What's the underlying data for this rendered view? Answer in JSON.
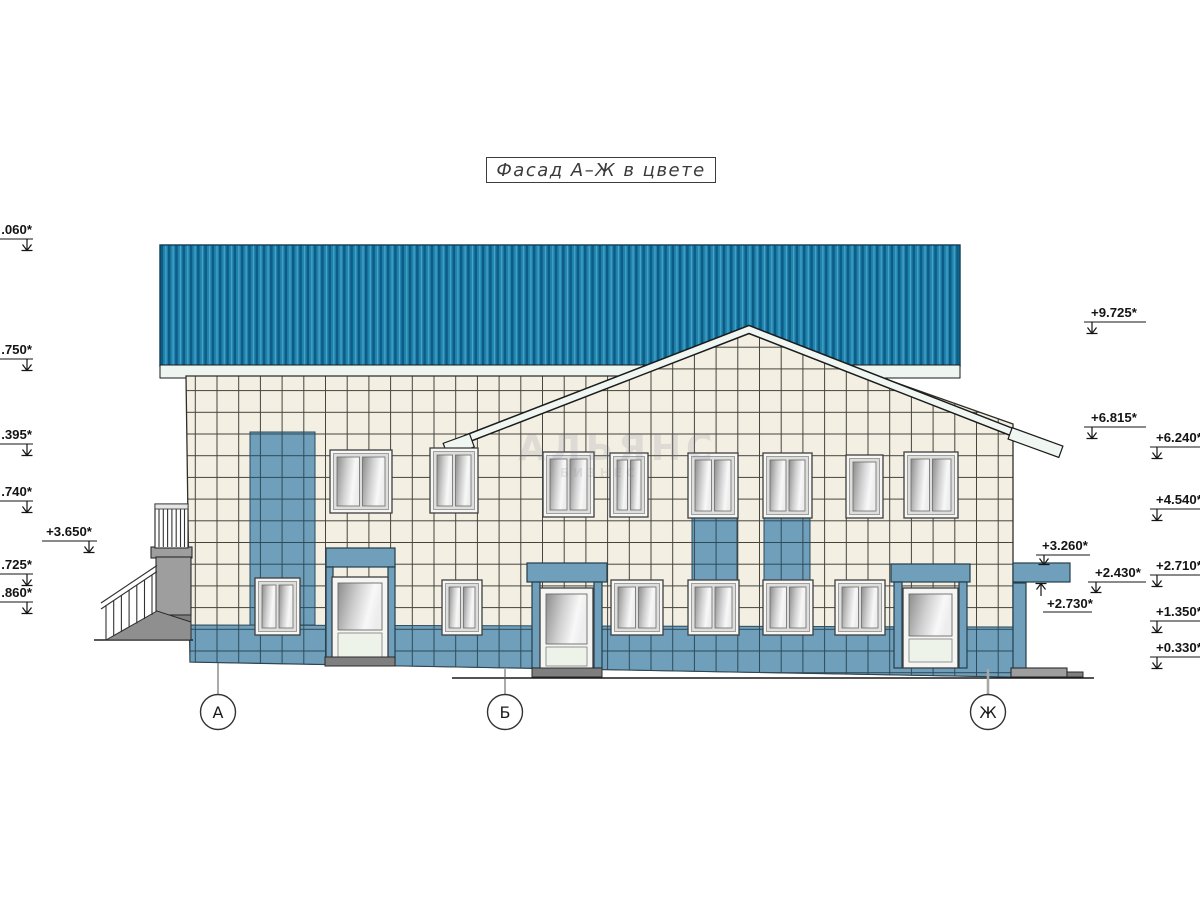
{
  "title": "Фасад А–Ж в цвете",
  "watermark": {
    "main": "АЛЬЯНС",
    "sub": "БИЗНЕС"
  },
  "axis_bubbles": [
    {
      "label": "А"
    },
    {
      "label": "Б"
    },
    {
      "label": "Ж"
    }
  ],
  "elevation_markers": {
    "left": [
      {
        "label": ".060*"
      },
      {
        "label": ".750*"
      },
      {
        "label": ".395*"
      },
      {
        "label": ".740*"
      },
      {
        "label": "+3.650*"
      },
      {
        "label": ".725*"
      },
      {
        "label": ".860*"
      }
    ],
    "right_inner": [
      {
        "label": "+9.725*"
      },
      {
        "label": "+6.815*"
      },
      {
        "label": "+3.260*"
      },
      {
        "label": "+2.430*"
      },
      {
        "label": "+2.730*"
      }
    ],
    "right_edge": [
      {
        "label": "+6.240*"
      },
      {
        "label": "+4.540*"
      },
      {
        "label": "+2.710*"
      },
      {
        "label": "+1.350*"
      },
      {
        "label": "+0.330*"
      }
    ]
  },
  "colors": {
    "roof_teal": "#1f83ad",
    "roof_stripe_dark": "#0c5c85",
    "facade_cream": "#f3efe3",
    "accent_blue": "#6f9fbb",
    "grid_line": "#45443d",
    "gray_concrete": "#9e9e9e"
  }
}
